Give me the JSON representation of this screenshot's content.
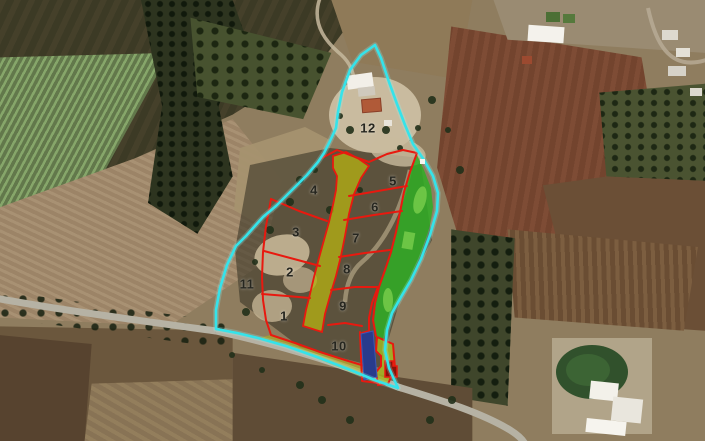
{
  "map": {
    "kind": "satellite-cadastral-plan",
    "plot_labels": [
      {
        "id": "plot-1",
        "text": "1",
        "x": 284,
        "y": 316
      },
      {
        "id": "plot-2",
        "text": "2",
        "x": 290,
        "y": 272
      },
      {
        "id": "plot-3",
        "text": "3",
        "x": 296,
        "y": 232
      },
      {
        "id": "plot-4",
        "text": "4",
        "x": 314,
        "y": 190
      },
      {
        "id": "plot-5",
        "text": "5",
        "x": 393,
        "y": 181
      },
      {
        "id": "plot-6",
        "text": "6",
        "x": 375,
        "y": 207
      },
      {
        "id": "plot-7",
        "text": "7",
        "x": 356,
        "y": 238
      },
      {
        "id": "plot-8",
        "text": "8",
        "x": 347,
        "y": 269
      },
      {
        "id": "plot-9",
        "text": "9",
        "x": 343,
        "y": 306
      },
      {
        "id": "plot-10",
        "text": "10",
        "x": 339,
        "y": 346
      },
      {
        "id": "plot-11",
        "text": "11",
        "x": 247,
        "y": 284
      },
      {
        "id": "plot-12",
        "text": "12",
        "x": 368,
        "y": 128
      }
    ],
    "colors": {
      "site_boundary": "#35e3ea",
      "site_boundary_glow": "#8ff6f8",
      "plot_lines": "#e8190f",
      "road_reserve": "#b7b312",
      "green_area": "#2fae25",
      "green_area_light": "#7fd14f",
      "blue_feature": "#293b8c",
      "pocket_fill": "#a3b41f",
      "pocket_inner": "#8a1208"
    }
  }
}
